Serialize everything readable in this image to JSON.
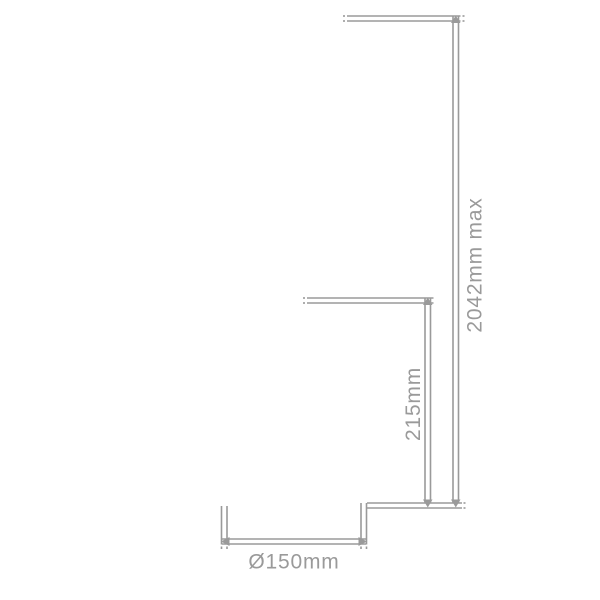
{
  "diagram": {
    "type": "product-dimension-drawing",
    "labels": {
      "max_drop": "2042mm max",
      "height": "215mm",
      "diameter": "Ø150mm"
    }
  },
  "colors": {
    "line": "#9a9a9a",
    "text": "#9a9a9a",
    "background": "#ffffff"
  }
}
